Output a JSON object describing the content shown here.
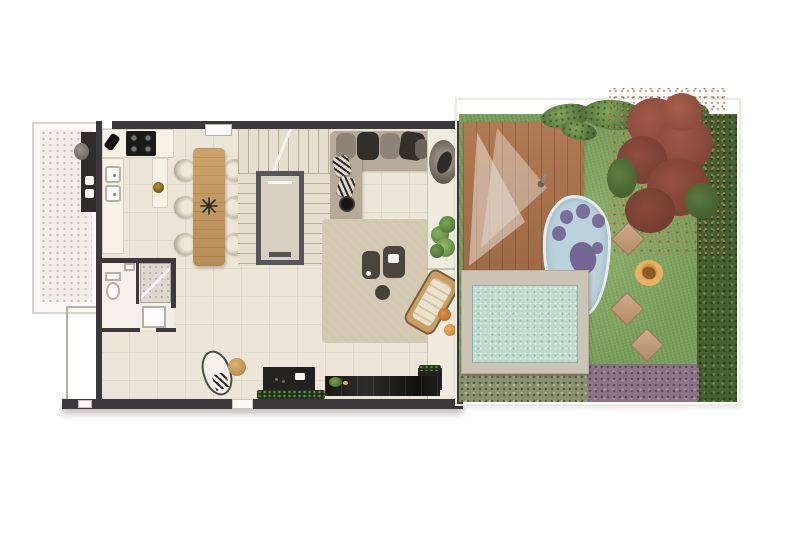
{
  "page": {
    "type": "3d-rendered architectural floor plan with private garden, top-down view",
    "background": "#ffffff",
    "visible_text": []
  },
  "palette": {
    "wall": "#3b393b",
    "floor": "#ece6d8",
    "balcony_floor": "#f0eee7",
    "counter": "#f7f2e6",
    "appliance_black": "#1b1a18",
    "wood": "#c19b64",
    "stairs": "#d8d0c0",
    "elevator_frame": "#56555b",
    "sofa": "#b6ab9a",
    "cushion_dark": "#35312d",
    "rug": "#d2c7b0",
    "furniture_dark": "#4a453d",
    "deck_wood": "#aa744d",
    "grass": "#7ba05e",
    "hedge": "#46612f",
    "pond_water": "#bad2dc",
    "paw_purple": "#6f5f91",
    "pool_deck": "#ccc5b6",
    "pool_water": "#bcdacd",
    "stepping_stone": "#c7a384",
    "pet_bed_orange": "#dfa254",
    "tree_bloom": "#8e4c3c",
    "shrub_olive": "#8a9070",
    "shrub_purple": "#8d7386",
    "accent_orange": "#d07a2e"
  },
  "floorplan": {
    "interior": {
      "rooms": [
        {
          "id": "balcony",
          "description": "side service balcony with dotted floor and dark grill counter"
        },
        {
          "id": "kitchen",
          "description": "L-kitchen with 4-burner cooktop, double sink, bowl on peninsula"
        },
        {
          "id": "dining",
          "description": "wood dining table for six with dark starburst centerpiece"
        },
        {
          "id": "stair-core",
          "description": "U-shaped staircase wrapping an elevator shaft"
        },
        {
          "id": "living",
          "description": "living room with corner sofa, striped pillows, rug, coffee tables"
        },
        {
          "id": "bathroom",
          "description": "bathroom with toilet, shelf, glass shower and tray"
        },
        {
          "id": "terrace-strip",
          "description": "narrow terrace with hanging chair, potted plant, wood lounger, planter"
        }
      ],
      "objects": [
        "cooktop-4-burner",
        "double-sink",
        "prep-bowl",
        "dining-table",
        "dining-chair-x6",
        "elevator",
        "stair-treads",
        "corner-sofa",
        "striped-pillow-x2",
        "round-side-table",
        "coffee-table-x2",
        "floor-pouf",
        "rug",
        "hanging-chair",
        "potted-plant",
        "wood-lounger",
        "orange-cushion-x2",
        "toilet",
        "shower",
        "shower-tray",
        "chaise-lounge",
        "tan-pouf",
        "media-cabinet",
        "black-counter",
        "planter-greenery",
        "doormat-x2",
        "window-shelf"
      ]
    },
    "exterior": {
      "features": [
        "wood-deck",
        "sheer-teepee-canopy",
        "paw-shaped-pet-pond",
        "purple-paw-print",
        "rectangular-swimming-pool",
        "stepping-stone-x3",
        "round-pet-bed",
        "red-flowering-tree",
        "top-foliage",
        "right-hedge",
        "olive-shrub-border",
        "purple-shrub-border",
        "lawn"
      ]
    }
  }
}
